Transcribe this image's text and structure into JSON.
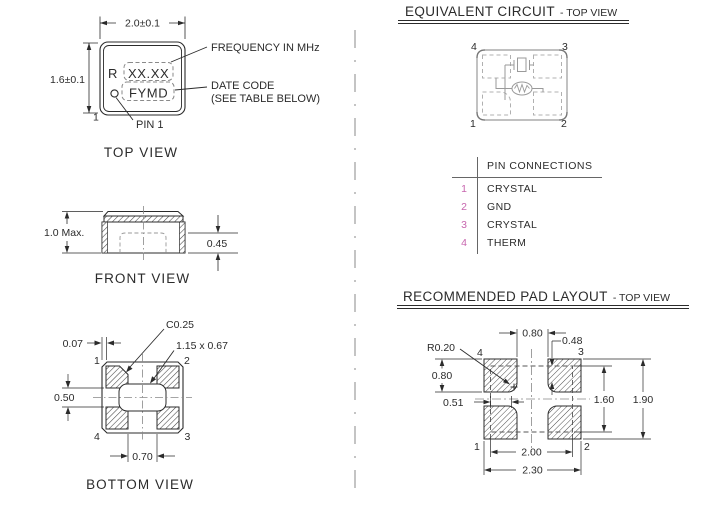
{
  "colors": {
    "line": "#2b2b2b",
    "circuit_gray": "#9a9a9a",
    "pin_magenta": "#c765ae",
    "dash_gray": "#8a8a8a"
  },
  "top_view": {
    "label": "TOP VIEW",
    "dim_width": "2.0±0.1",
    "dim_height": "1.6±0.1",
    "marking_prefix": "R",
    "marking_frequency": "XX.XX",
    "marking_datecode": "FYMD",
    "pin1_number": "1",
    "callout_frequency": "FREQUENCY IN MHz",
    "callout_datecode_line1": "DATE CODE",
    "callout_datecode_line2": "(SEE TABLE BELOW)",
    "callout_pin1": "PIN 1"
  },
  "front_view": {
    "label": "FRONT VIEW",
    "dim_height_max": "1.0 Max.",
    "dim_terminal_height": "0.45"
  },
  "bottom_view": {
    "label": "BOTTOM VIEW",
    "dim_edge_to_pad": "0.07",
    "dim_pad_gap_vertical": "0.50",
    "dim_pad_gap_horizontal": "0.70",
    "callout_chamfer": "C0.25",
    "callout_cavity": "1.15 x 0.67",
    "pin_top_left": "1",
    "pin_top_right": "2",
    "pin_bottom_right": "3",
    "pin_bottom_left": "4"
  },
  "equivalent_circuit": {
    "title": "EQUIVALENT CIRCUIT",
    "title_suffix": "- TOP VIEW",
    "pin_top_left": "4",
    "pin_top_right": "3",
    "pin_bottom_left": "1",
    "pin_bottom_right": "2"
  },
  "pin_connections": {
    "header": "PIN CONNECTIONS",
    "rows": [
      {
        "pin": "1",
        "connection": "CRYSTAL"
      },
      {
        "pin": "2",
        "connection": "GND"
      },
      {
        "pin": "3",
        "connection": "CRYSTAL"
      },
      {
        "pin": "4",
        "connection": "THERM"
      }
    ]
  },
  "pad_layout": {
    "title": "RECOMMENDED PAD LAYOUT",
    "title_suffix": "- TOP VIEW",
    "dim_pad_gap_top": "0.80",
    "dim_notch_vertical": "0.48",
    "dim_corner_radius": "R0.20",
    "dim_pad_height": "0.80",
    "dim_notch_horizontal": "0.51",
    "dim_body_height": "1.60",
    "dim_overall_height": "1.90",
    "dim_body_width": "2.00",
    "dim_overall_width": "2.30",
    "pin_top_left": "4",
    "pin_top_right": "3",
    "pin_bottom_left": "1",
    "pin_bottom_right": "2"
  }
}
